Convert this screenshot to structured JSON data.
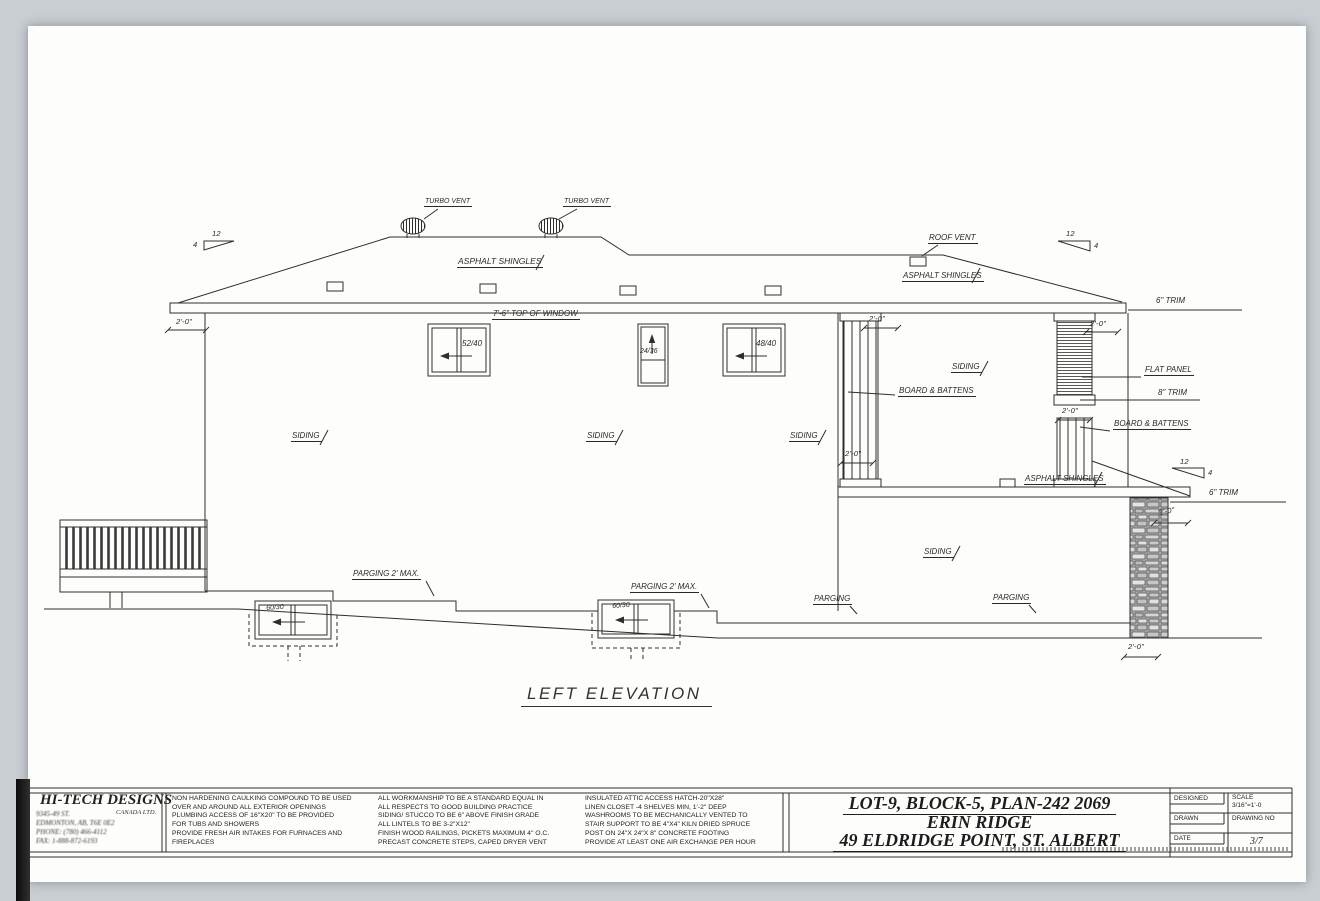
{
  "drawing_title": "LEFT ELEVATION",
  "labels": {
    "turbo_vent": "TURBO VENT",
    "roof_vent": "ROOF VENT",
    "asphalt_shingles": "ASPHALT SHINGLES",
    "top_of_window": "7'-6\" TOP OF WINDOW",
    "siding": "SIDING",
    "board_and_battens": "BOARD & BATTENS",
    "flat_panel": "FLAT PANEL",
    "trim_6in": "6\" TRIM",
    "trim_8in": "8\" TRIM",
    "parging_2ft_max": "PARGING 2' MAX.",
    "parging": "PARGING",
    "dim_2ft_0in": "2'-0\"",
    "slope_rise": "12",
    "slope_run": "4"
  },
  "window_sizes": {
    "main_1": "52/40",
    "main_2": "24/36",
    "main_3": "48/40",
    "basement_1": "60/30",
    "basement_2": "60/30"
  },
  "title_block": {
    "company": {
      "name": "HI-TECH DESIGNS",
      "subtitle": "CANADA LTD.",
      "address_line1": "9345-49 ST.",
      "address_line2": "EDMONTON, AB, T6E 0E2",
      "phone": "PHONE: (780) 466-4112",
      "fax": "FAX: 1-888-872-6193"
    },
    "notes_col1": [
      "NON HARDENING CAULKING COMPOUND TO BE USED",
      "OVER AND AROUND ALL EXTERIOR OPENINGS",
      "PLUMBING ACCESS OF 16\"X20\" TO BE PROVIDED",
      "FOR TUBS AND SHOWERS",
      "PROVIDE FRESH AIR INTAKES FOR FURNACES AND",
      "FIREPLACES"
    ],
    "notes_col2": [
      "ALL WORKMANSHIP TO BE A STANDARD EQUAL IN",
      "ALL RESPECTS TO GOOD BUILDING PRACTICE",
      "SIDING/ STUCCO TO BE 6\" ABOVE FINISH GRADE",
      "ALL LINTELS TO BE 3-2\"X12\"",
      "FINISH WOOD RAILINGS, PICKETS MAXIMUM 4\" O.C.",
      "PRECAST CONCRETE STEPS, CAPED DRYER VENT"
    ],
    "notes_col3": [
      "INSULATED ATTIC ACCESS HATCH-20\"X28\"",
      "LINEN CLOSET -4 SHELVES MIN, 1'-2\" DEEP",
      "WASHROOMS TO BE MECHANICALLY VENTED TO",
      "STAIR SUPPORT TO BE 4\"X4\" KILN DRIED SPRUCE",
      "POST ON 24\"X 24\"X 8\" CONCRETE FOOTING",
      "PROVIDE AT LEAST ONE AIR EXCHANGE PER HOUR"
    ],
    "project": {
      "line1": "LOT-9, BLOCK-5, PLAN-242 2069",
      "line2": "ERIN RIDGE",
      "line3": "49 ELDRIDGE POINT, ST. ALBERT"
    },
    "fields": {
      "designed_label": "DESIGNED",
      "drawn_label": "DRAWN",
      "date_label": "DATE",
      "scale_label": "SCALE",
      "scale_value": "3/16\"=1'-0",
      "drawing_no_label": "DRAWING NO",
      "drawing_no_value": "3/7"
    }
  }
}
